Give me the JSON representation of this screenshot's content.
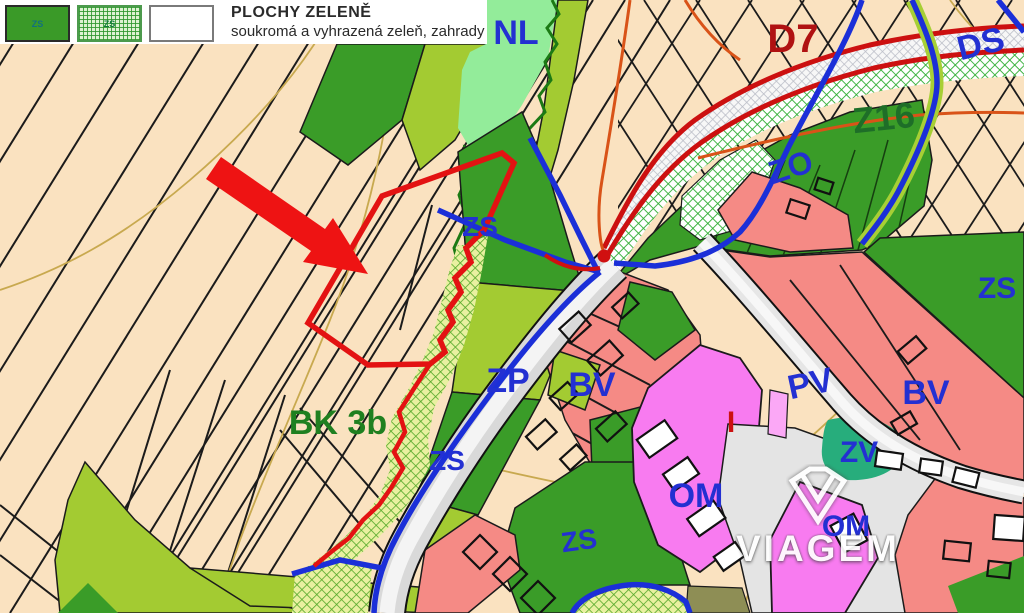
{
  "legend": {
    "title": "PLOCHY ZELENĚ",
    "subtitle": "soukromá  a vyhrazená zeleň, zahrady",
    "swatch_solid_label": "ZS",
    "swatch_hatch_label": "ZS"
  },
  "labels": {
    "nl": "NL",
    "d7": "D7",
    "ds": "DS",
    "z16": "Z16",
    "zo": "ZO",
    "zs_top": "ZS",
    "zp": "ZP",
    "zs_mid": "ZS",
    "bk3b": "BK 3b",
    "bv_center": "BV",
    "pv": "PV",
    "bv_right": "BV",
    "zs_right": "ZS",
    "zv": "ZV",
    "om": "OM",
    "om2": "OM",
    "zs_bottom": "ZS",
    "i_mark": "I"
  },
  "watermark": {
    "name": "VIAGEM"
  },
  "colors": {
    "label_blue": "#2330D2",
    "label_dark_red": "#B01212",
    "label_dark_green": "#1E6E28",
    "beige": "#FAE2C0",
    "dark_green": "#3A9C28",
    "apple_green": "#A3CB32",
    "mint_green": "#93EC9A",
    "salmon": "#F58A85",
    "magenta": "#F87BF0",
    "teal_zv": "#27AD7C",
    "road_gray": "#DCDCDC",
    "boundary_blue": "#1B2FD8",
    "boundary_red": "#E31212",
    "contour_tan": "#C8A94F",
    "contour_orange": "#D95318"
  }
}
